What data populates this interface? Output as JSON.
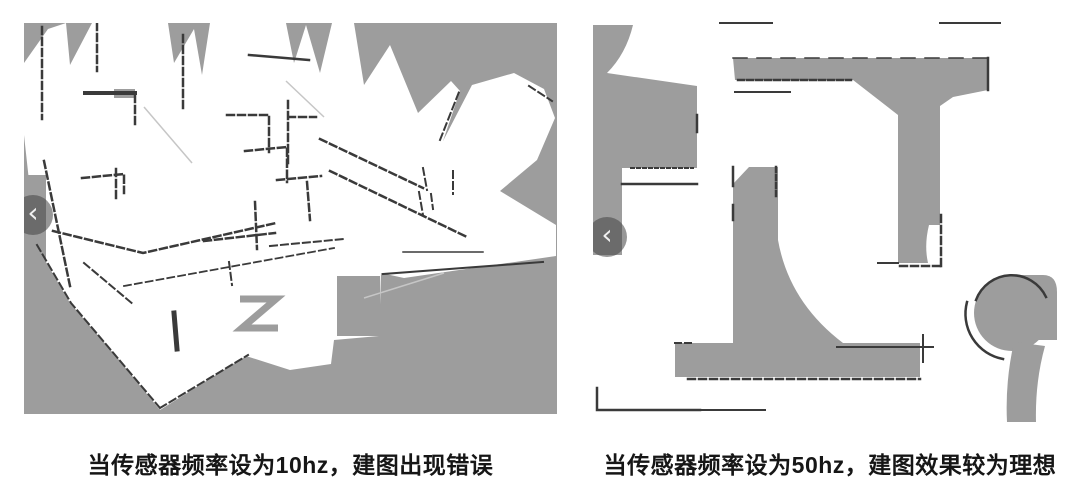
{
  "figures": [
    {
      "id": "map-10hz",
      "caption": "当传感器频率设为10hz，建图出现错误"
    },
    {
      "id": "map-50hz",
      "caption": "当传感器频率设为50hz，建图效果较为理想"
    }
  ],
  "icons": {
    "chevron_left": "‹"
  },
  "colors": {
    "map_unknown_gray": "#9d9d9d",
    "wall_dark": "#3a3a3a",
    "caption_text": "#161616",
    "nav_circle": "rgba(66,66,66,0.55)",
    "nav_glyph": "#f0f0f0"
  }
}
